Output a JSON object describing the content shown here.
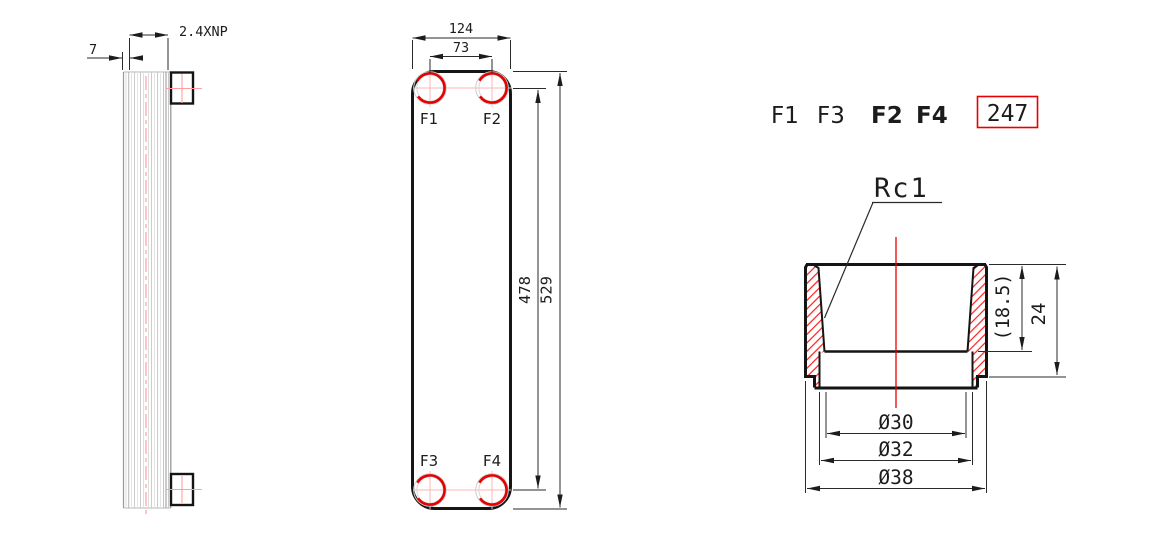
{
  "drawing_type": "plate-heat-exchanger-technical-drawing",
  "side_view": {
    "dim_end_plate_thickness": "7",
    "dim_plate_stack": "2.4XNP"
  },
  "front_view": {
    "dim_width": "124",
    "dim_port_horizontal_span": "73",
    "dim_port_vertical_span": "478",
    "dim_height": "529",
    "port_f1": "F1",
    "port_f2": "F2",
    "port_f3": "F3",
    "port_f4": "F4"
  },
  "legend": {
    "f1": "F1",
    "f3": "F3",
    "f2": "F2",
    "f4": "F4",
    "stamp": "247"
  },
  "section": {
    "thread_label": "Rc1",
    "dim_thread_depth": "(18.5)",
    "dim_height": "24",
    "dim_bore": "Ø30",
    "dim_counterbore": "Ø32",
    "dim_outer": "Ø38"
  },
  "colors": {
    "line_black": "#1c1c1c",
    "accent_red": "#e80000",
    "centerline_pink": "#ff9f9f",
    "plate_gray": "#c8c8c8"
  }
}
